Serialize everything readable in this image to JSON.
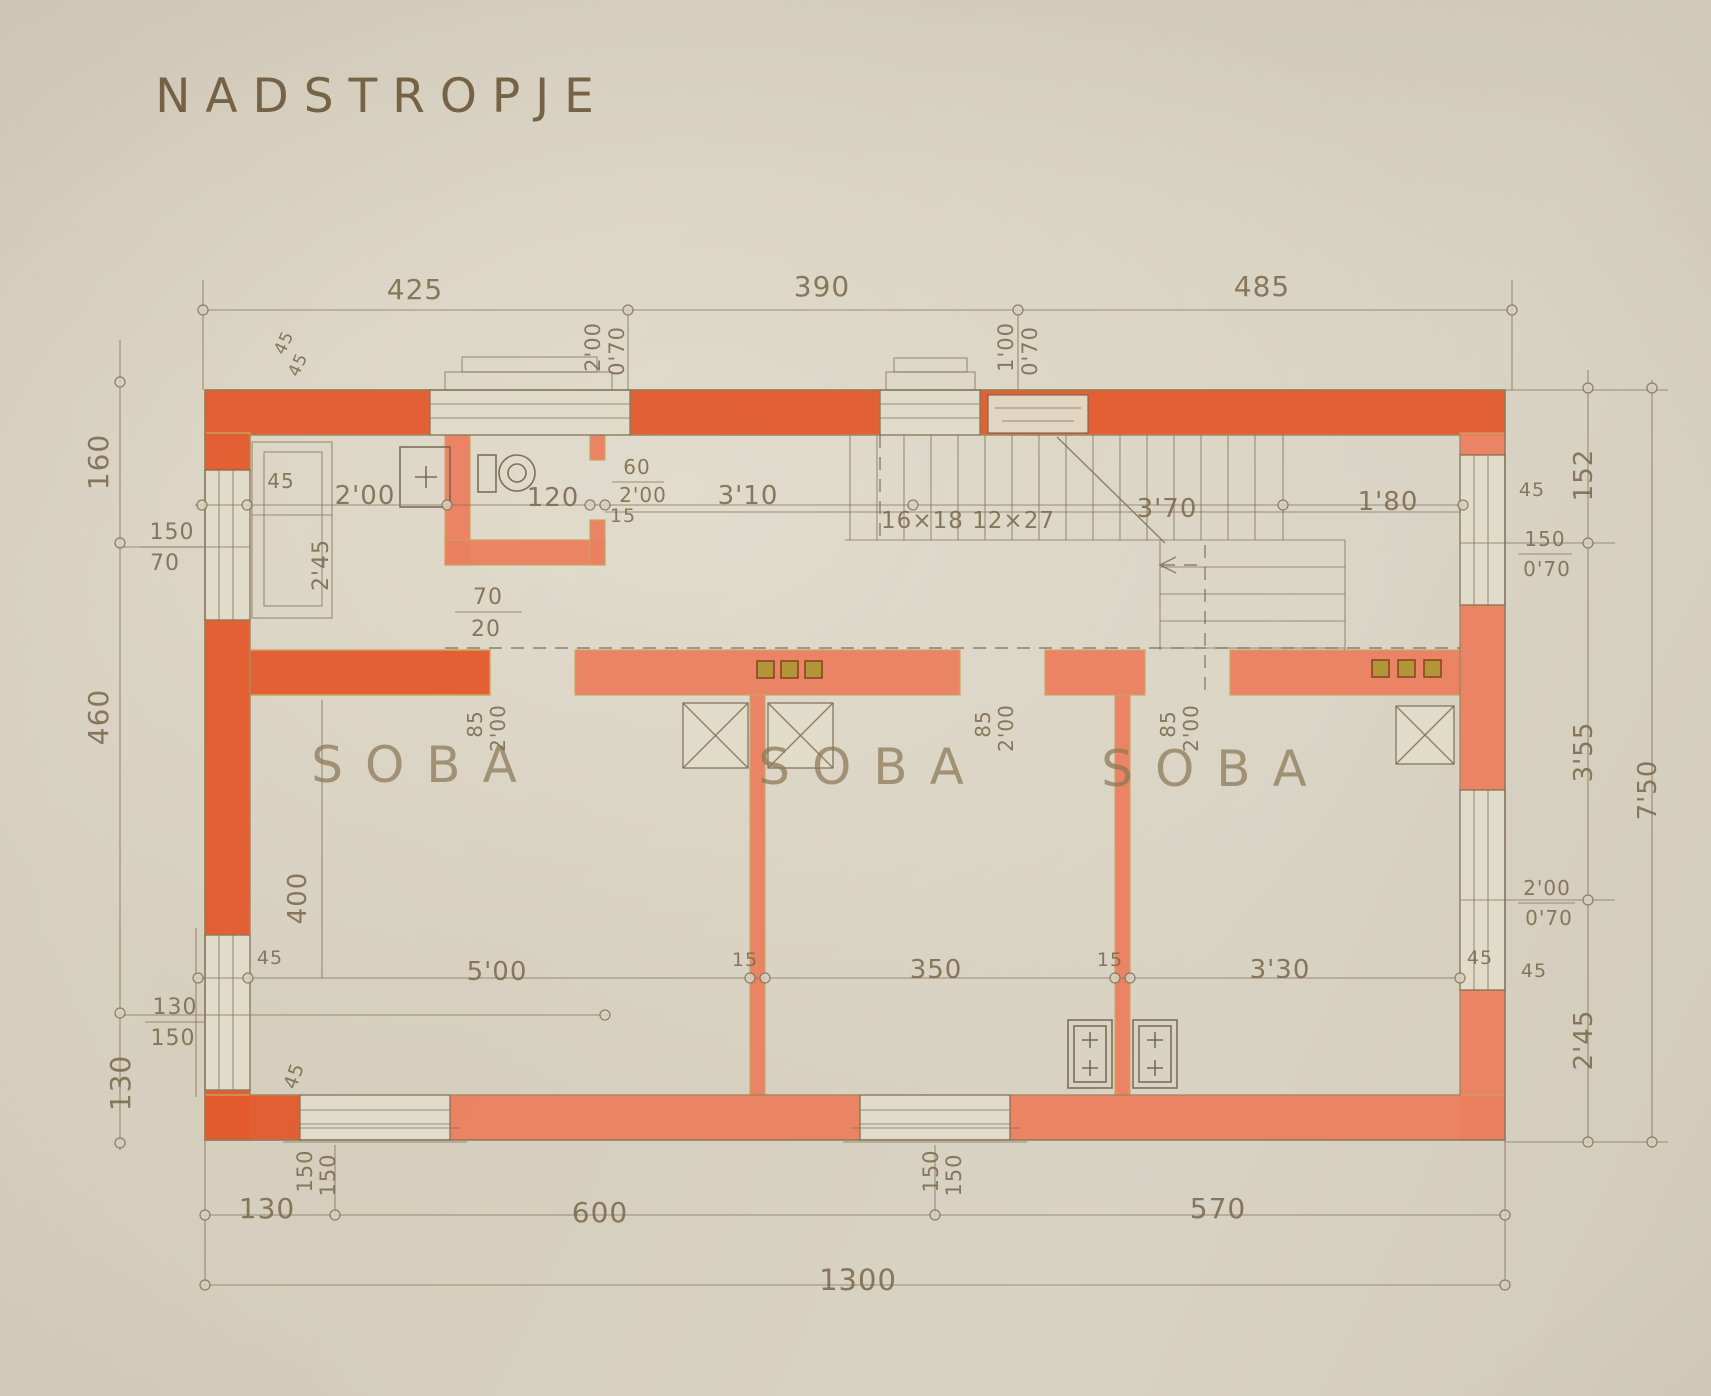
{
  "sheet": {
    "title": "NADSTROPJE",
    "drawing_type": "floor plan",
    "rooms": [
      "SOBA",
      "SOBA",
      "SOBA"
    ],
    "stair_note": "16×18 12×27",
    "palette": {
      "paper": "#d8d1c1",
      "wall_orange": "#e35a2d",
      "wall_salmon": "#ec8060",
      "ink": "#7a6950",
      "label_ink": "#7c6a4d",
      "vent_olive": "#ab9733"
    },
    "overall_width": "1300",
    "overall_height": "7'50"
  },
  "annotations": [
    {
      "name": "plan-title",
      "text": "NADSTROPJE",
      "x": 382,
      "y": 112,
      "rot": 0,
      "size": 47,
      "cls": "title-lbl"
    },
    {
      "name": "dim-top-425",
      "text": "425",
      "x": 415,
      "y": 299,
      "size": 28
    },
    {
      "name": "dim-top-390",
      "text": "390",
      "x": 822,
      "y": 296,
      "size": 28
    },
    {
      "name": "dim-top-485",
      "text": "485",
      "x": 1262,
      "y": 296,
      "size": 28
    },
    {
      "name": "dim-top-window-200",
      "text": "2'00",
      "x": 600,
      "y": 347,
      "rot": -90,
      "size": 21
    },
    {
      "name": "dim-top-window-070",
      "text": "0'70",
      "x": 624,
      "y": 351,
      "rot": -90,
      "size": 21
    },
    {
      "name": "dim-top-window-100",
      "text": "1'00",
      "x": 1013,
      "y": 347,
      "rot": -90,
      "size": 21
    },
    {
      "name": "dim-top-window-070b",
      "text": "0'70",
      "x": 1037,
      "y": 351,
      "rot": -90,
      "size": 21
    },
    {
      "name": "dim-wall-45a",
      "text": "45",
      "x": 289,
      "y": 345,
      "rot": -65,
      "size": 17
    },
    {
      "name": "dim-wall-45b",
      "text": "45",
      "x": 303,
      "y": 367,
      "rot": -65,
      "size": 17
    },
    {
      "name": "dim-left-160",
      "text": "160",
      "x": 108,
      "y": 462,
      "rot": -90,
      "size": 28
    },
    {
      "name": "dim-left-150",
      "text": "150",
      "x": 172,
      "y": 539,
      "size": 22
    },
    {
      "name": "dim-left-70",
      "text": "70",
      "x": 165,
      "y": 570,
      "size": 22
    },
    {
      "name": "dim-left-460",
      "text": "460",
      "x": 108,
      "y": 717,
      "rot": -90,
      "size": 28
    },
    {
      "name": "dim-left-130v",
      "text": "130",
      "x": 130,
      "y": 1083,
      "rot": -90,
      "size": 28
    },
    {
      "name": "dim-left-win-130",
      "text": "130",
      "x": 175,
      "y": 1014,
      "size": 22
    },
    {
      "name": "dim-left-win-150",
      "text": "150",
      "x": 173,
      "y": 1045,
      "size": 22
    },
    {
      "name": "dim-niche-45",
      "text": "45",
      "x": 281,
      "y": 488,
      "size": 20
    },
    {
      "name": "dim-niche-245",
      "text": "2'45",
      "x": 328,
      "y": 565,
      "rot": -90,
      "size": 22
    },
    {
      "name": "dim-bath-200",
      "text": "2'00",
      "x": 365,
      "y": 504,
      "size": 26
    },
    {
      "name": "dim-wc-120",
      "text": "120",
      "x": 553,
      "y": 506,
      "size": 26
    },
    {
      "name": "dim-wc-15",
      "text": "15",
      "x": 623,
      "y": 522,
      "size": 19
    },
    {
      "name": "dim-wcdoor-60",
      "text": "60",
      "x": 637,
      "y": 474,
      "size": 20
    },
    {
      "name": "dim-wcdoor-200",
      "text": "2'00",
      "x": 643,
      "y": 502,
      "size": 20
    },
    {
      "name": "dim-corridor-310",
      "text": "3'10",
      "x": 748,
      "y": 504,
      "size": 26
    },
    {
      "name": "stair-note",
      "text": "16×18 12×27",
      "x": 968,
      "y": 528,
      "size": 23
    },
    {
      "name": "dim-stair-370",
      "text": "3'70",
      "x": 1167,
      "y": 517,
      "size": 26
    },
    {
      "name": "dim-stair-180",
      "text": "1'80",
      "x": 1388,
      "y": 510,
      "size": 26
    },
    {
      "name": "dim-corner-niche-70",
      "text": "70",
      "x": 488,
      "y": 604,
      "size": 22
    },
    {
      "name": "dim-corner-niche-20",
      "text": "20",
      "x": 486,
      "y": 636,
      "size": 22
    },
    {
      "name": "dim-right-45a",
      "text": "45",
      "x": 1532,
      "y": 496,
      "size": 19
    },
    {
      "name": "dim-right-win-150",
      "text": "150",
      "x": 1545,
      "y": 546,
      "size": 20
    },
    {
      "name": "dim-right-win-070",
      "text": "0'70",
      "x": 1547,
      "y": 576,
      "size": 20
    },
    {
      "name": "dim-right-152",
      "text": "152",
      "x": 1592,
      "y": 475,
      "rot": -90,
      "size": 26
    },
    {
      "name": "dim-right-355",
      "text": "3'55",
      "x": 1592,
      "y": 752,
      "rot": -90,
      "size": 26
    },
    {
      "name": "dim-right-750",
      "text": "7'50",
      "x": 1656,
      "y": 790,
      "rot": -90,
      "size": 26
    },
    {
      "name": "dim-right-win2-200",
      "text": "2'00",
      "x": 1547,
      "y": 895,
      "size": 20
    },
    {
      "name": "dim-right-win2-070",
      "text": "0'70",
      "x": 1549,
      "y": 925,
      "size": 20
    },
    {
      "name": "dim-right-45b",
      "text": "45",
      "x": 1534,
      "y": 977,
      "size": 19
    },
    {
      "name": "dim-right-245",
      "text": "2'45",
      "x": 1592,
      "y": 1040,
      "rot": -90,
      "size": 26
    },
    {
      "name": "dim-room1-400",
      "text": "400",
      "x": 306,
      "y": 898,
      "rot": -90,
      "size": 26
    },
    {
      "name": "dim-room1-500",
      "text": "5'00",
      "x": 497,
      "y": 980,
      "size": 26
    },
    {
      "name": "dim-partition-15a",
      "text": "15",
      "x": 745,
      "y": 966,
      "size": 19
    },
    {
      "name": "dim-room2-350",
      "text": "350",
      "x": 936,
      "y": 978,
      "size": 26
    },
    {
      "name": "dim-partition-15b",
      "text": "15",
      "x": 1110,
      "y": 966,
      "size": 19
    },
    {
      "name": "dim-room3-330",
      "text": "3'30",
      "x": 1280,
      "y": 978,
      "size": 26
    },
    {
      "name": "dim-rightwall-45",
      "text": "45",
      "x": 1480,
      "y": 964,
      "size": 19
    },
    {
      "name": "dim-bl-45",
      "text": "45",
      "x": 270,
      "y": 964,
      "size": 19
    },
    {
      "name": "dim-bl-45rot",
      "text": "45",
      "x": 300,
      "y": 1078,
      "rot": -70,
      "size": 19
    },
    {
      "name": "dim-bw1-150a",
      "text": "150",
      "x": 312,
      "y": 1171,
      "rot": -90,
      "size": 21
    },
    {
      "name": "dim-bw1-150b",
      "text": "150",
      "x": 335,
      "y": 1175,
      "rot": -90,
      "size": 21
    },
    {
      "name": "dim-bw2-150a",
      "text": "150",
      "x": 938,
      "y": 1171,
      "rot": -90,
      "size": 21
    },
    {
      "name": "dim-bw2-150b",
      "text": "150",
      "x": 961,
      "y": 1175,
      "rot": -90,
      "size": 21
    },
    {
      "name": "dim-bottom-130",
      "text": "130",
      "x": 267,
      "y": 1218,
      "size": 28
    },
    {
      "name": "dim-bottom-600",
      "text": "600",
      "x": 600,
      "y": 1222,
      "size": 28
    },
    {
      "name": "dim-bottom-570",
      "text": "570",
      "x": 1218,
      "y": 1218,
      "size": 28
    },
    {
      "name": "dim-bottom-1300",
      "text": "1300",
      "x": 858,
      "y": 1290,
      "size": 29
    },
    {
      "name": "room-label-1",
      "text": "SOBA",
      "x": 425,
      "y": 782,
      "size": 50,
      "cls": "room-lbl"
    },
    {
      "name": "room-label-2",
      "text": "SOBA",
      "x": 872,
      "y": 784,
      "size": 50,
      "cls": "room-lbl"
    },
    {
      "name": "room-label-3",
      "text": "SOBA",
      "x": 1215,
      "y": 786,
      "size": 50,
      "cls": "room-lbl"
    },
    {
      "name": "dim-door1-85",
      "text": "85",
      "x": 482,
      "y": 724,
      "rot": -90,
      "size": 20
    },
    {
      "name": "dim-door1-200",
      "text": "2'00",
      "x": 505,
      "y": 728,
      "rot": -90,
      "size": 20
    },
    {
      "name": "dim-door2-85",
      "text": "85",
      "x": 990,
      "y": 724,
      "rot": -90,
      "size": 20
    },
    {
      "name": "dim-door2-200",
      "text": "2'00",
      "x": 1013,
      "y": 728,
      "rot": -90,
      "size": 20
    },
    {
      "name": "dim-door3-85",
      "text": "85",
      "x": 1175,
      "y": 724,
      "rot": -90,
      "size": 20
    },
    {
      "name": "dim-door3-200",
      "text": "2'00",
      "x": 1198,
      "y": 728,
      "rot": -90,
      "size": 20
    }
  ]
}
